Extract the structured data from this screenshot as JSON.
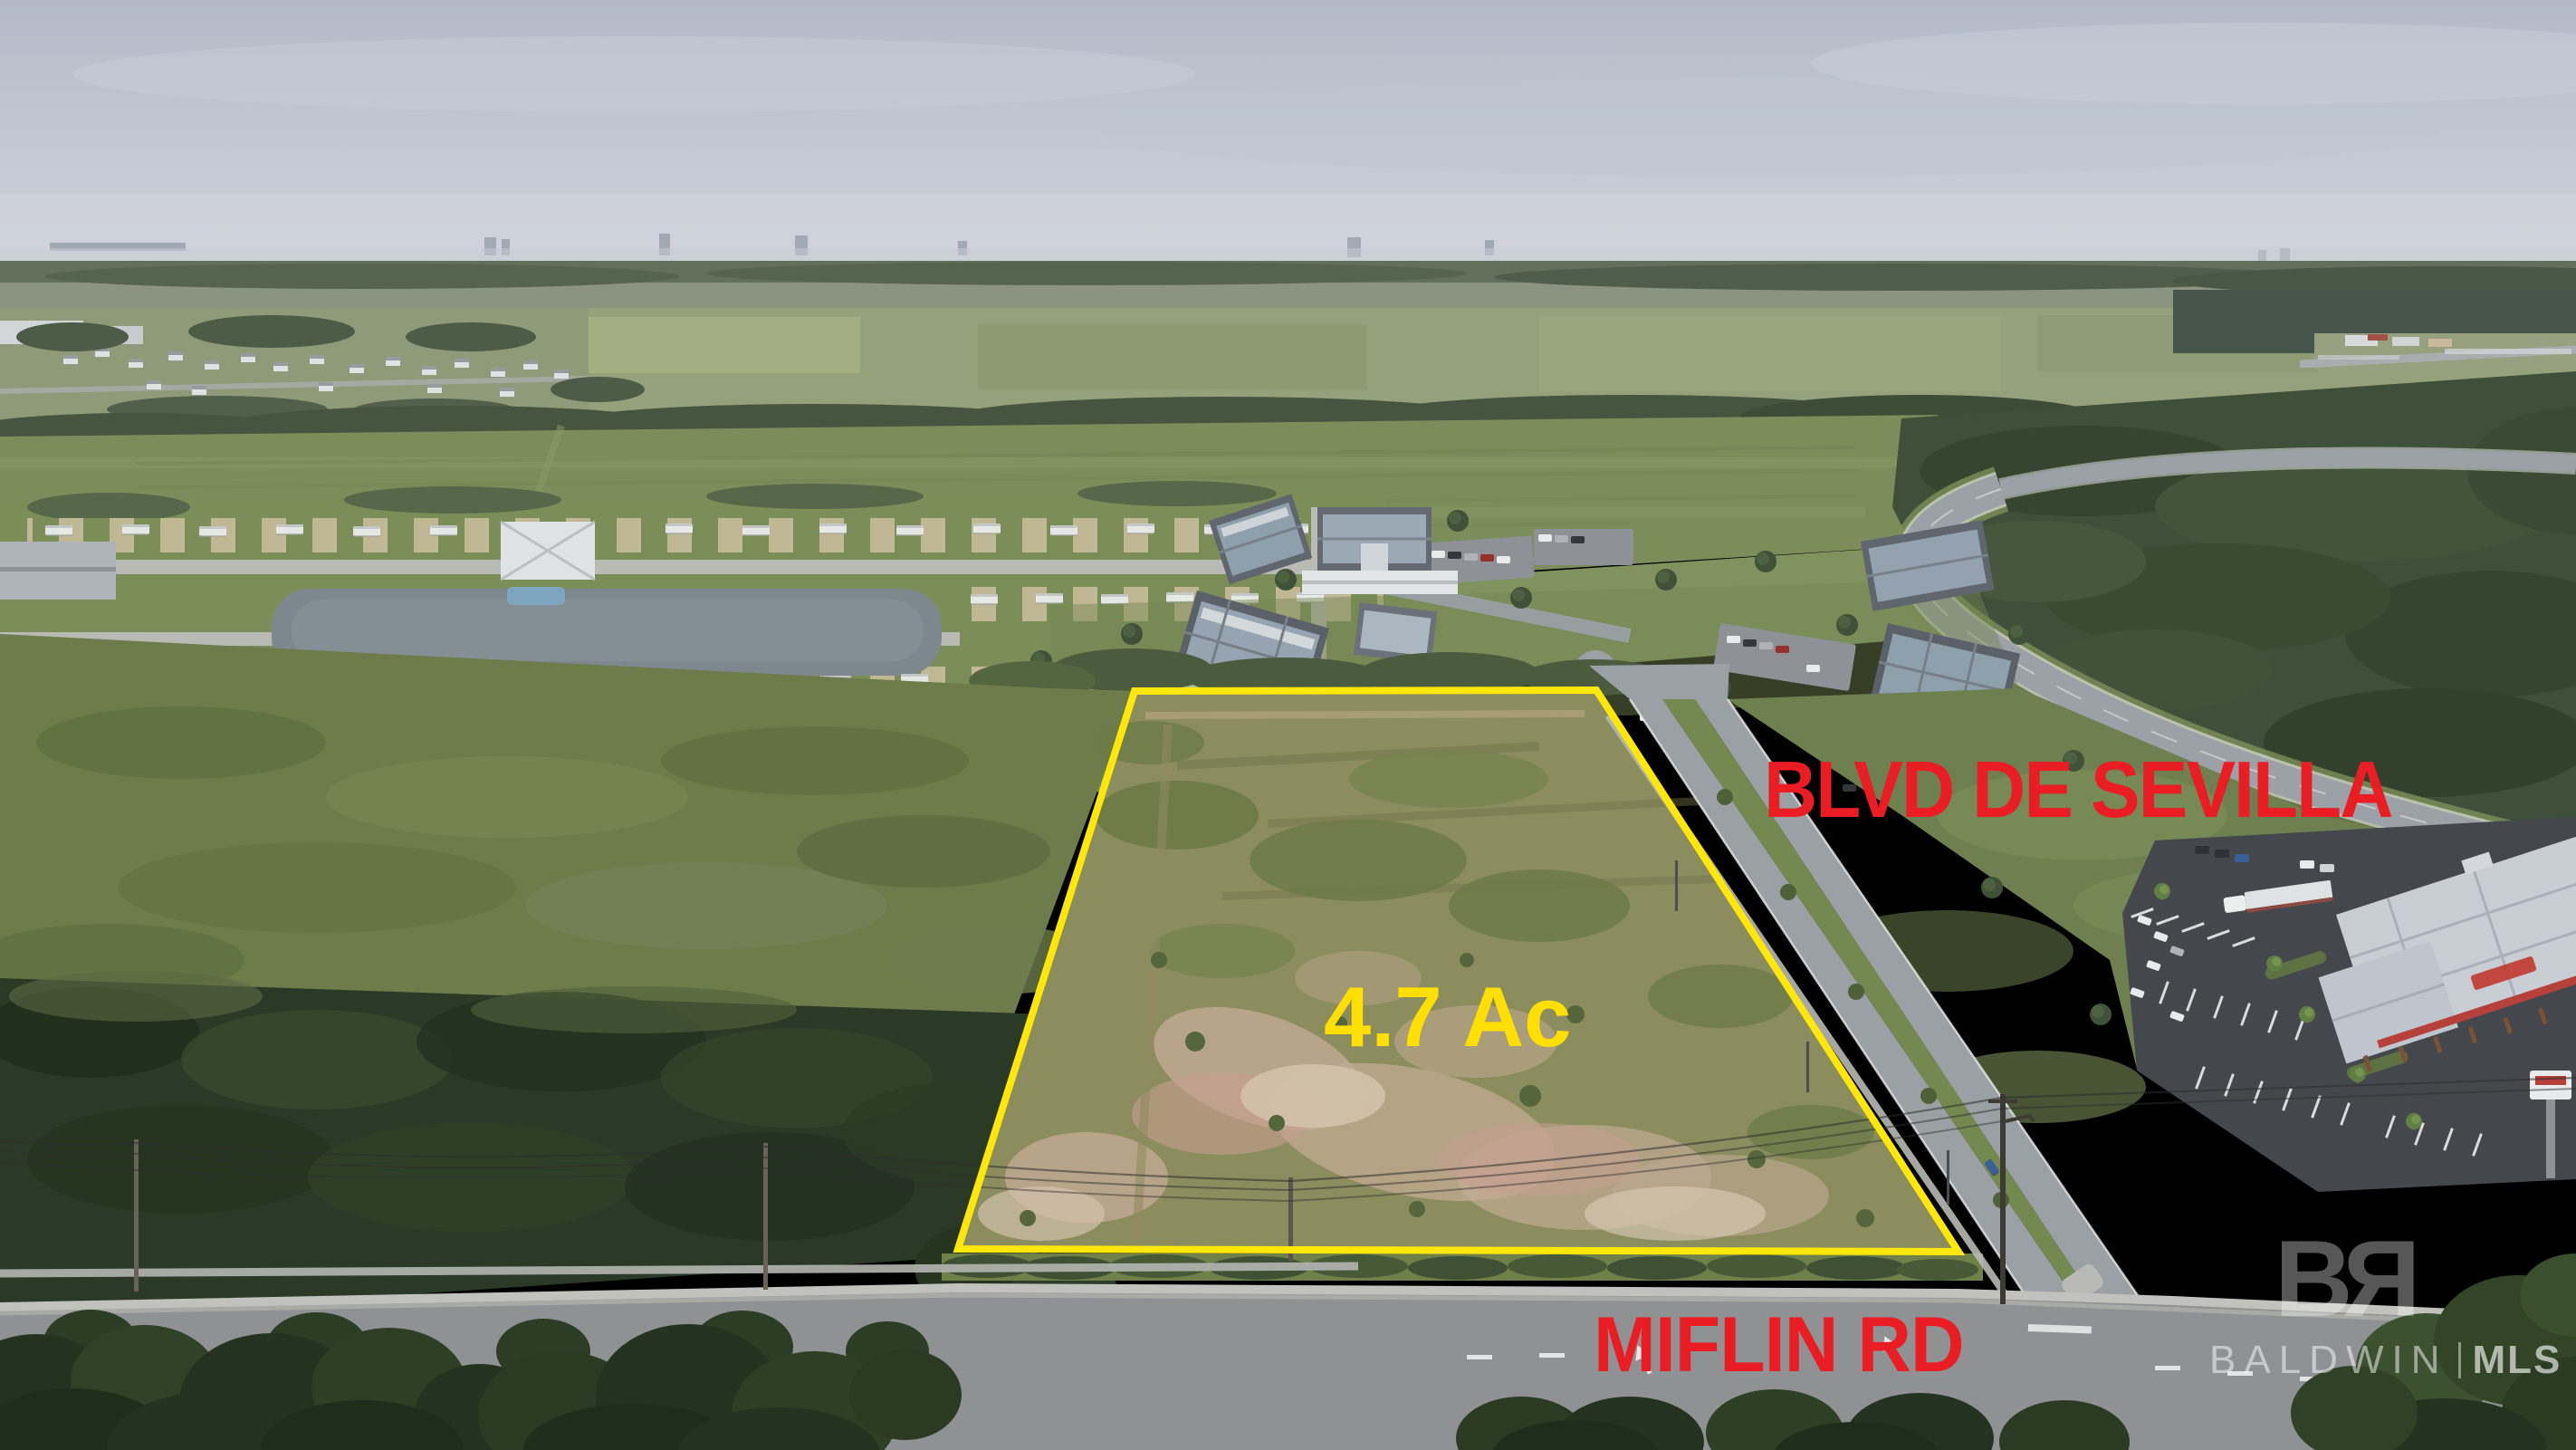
{
  "annotations": {
    "top_road": "BLVD DE SEVILLA",
    "parcel_area": "4.7 Ac",
    "bottom_road": "MIFLIN RD"
  },
  "watermark": {
    "logo_b": "B",
    "logo_r": "R",
    "brand": "BALDWIN",
    "suffix": "MLS"
  },
  "colors": {
    "annotation_red": "#ea1c24",
    "annotation_yellow": "#ffdf00",
    "parcel_outline": "#ffe70a",
    "watermark": "#ffffff"
  }
}
